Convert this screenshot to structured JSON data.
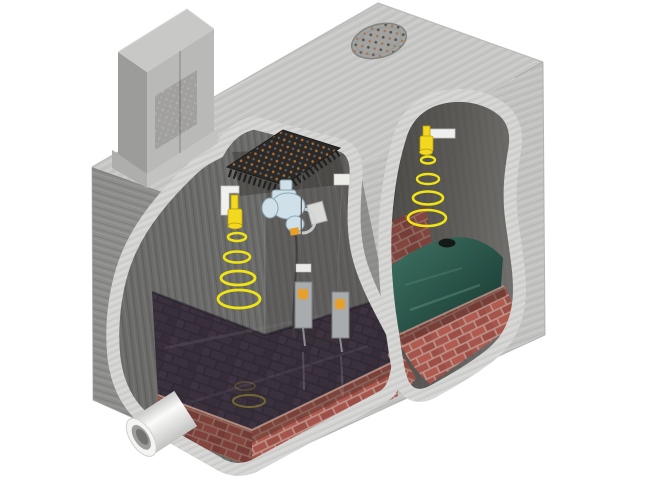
{
  "scene": {
    "kind": "3d-cutaway-illustration",
    "subject": "underground-chamber-with-level-sensors",
    "background": "#ffffff"
  },
  "palette": {
    "concrete_top": "#c7c8c6",
    "concrete_front": "#c2c3c1",
    "concrete_left": "#8d8e8c",
    "concrete_cut": "#d3d4d2",
    "interior_wall": "#6b6b69",
    "interior_wall_dark": "#4f4d4a",
    "brick_red": "#a5554c",
    "brick_mortar": "#bd948a",
    "brick_floor": "#4a3e45",
    "water_dark": "#2e2836",
    "water_teal": "#2a5a4f",
    "sensor_yellow": "#f2d81e",
    "ring_yellow": "#f0e414",
    "pump_blue": "#cfe0e8",
    "probe_metal": "#a8acae",
    "accent_orange": "#e8a02c",
    "pipe_white": "#f4f4f2",
    "grate_dark": "#2c2a28",
    "grate_rust": "#c27a36",
    "manhole_gray": "#a2a2a0",
    "cabinet_front": "#b9bab8",
    "cabinet_side": "#9c9d9b",
    "cabinet_top": "#c8c9c7",
    "cable_gray": "#3f3f3d"
  },
  "components": {
    "control_cabinet": "control-cabinet",
    "manhole_cover": "manhole-cover",
    "access_grate": "access-grate",
    "pump_unit": "pump-unit",
    "level_probes": "level-probes",
    "outlet_pipe": "outlet-pipe",
    "left_sensor": "ultrasonic-sensor-left-chamber",
    "right_sensor": "ultrasonic-sensor-right-chamber",
    "left_chamber": "wet-well-left-chamber",
    "right_chamber": "wet-well-right-chamber"
  },
  "sensors": {
    "left": {
      "signal_rings": 4
    },
    "right": {
      "signal_rings": 4
    },
    "water_reflection_rings": 1
  }
}
